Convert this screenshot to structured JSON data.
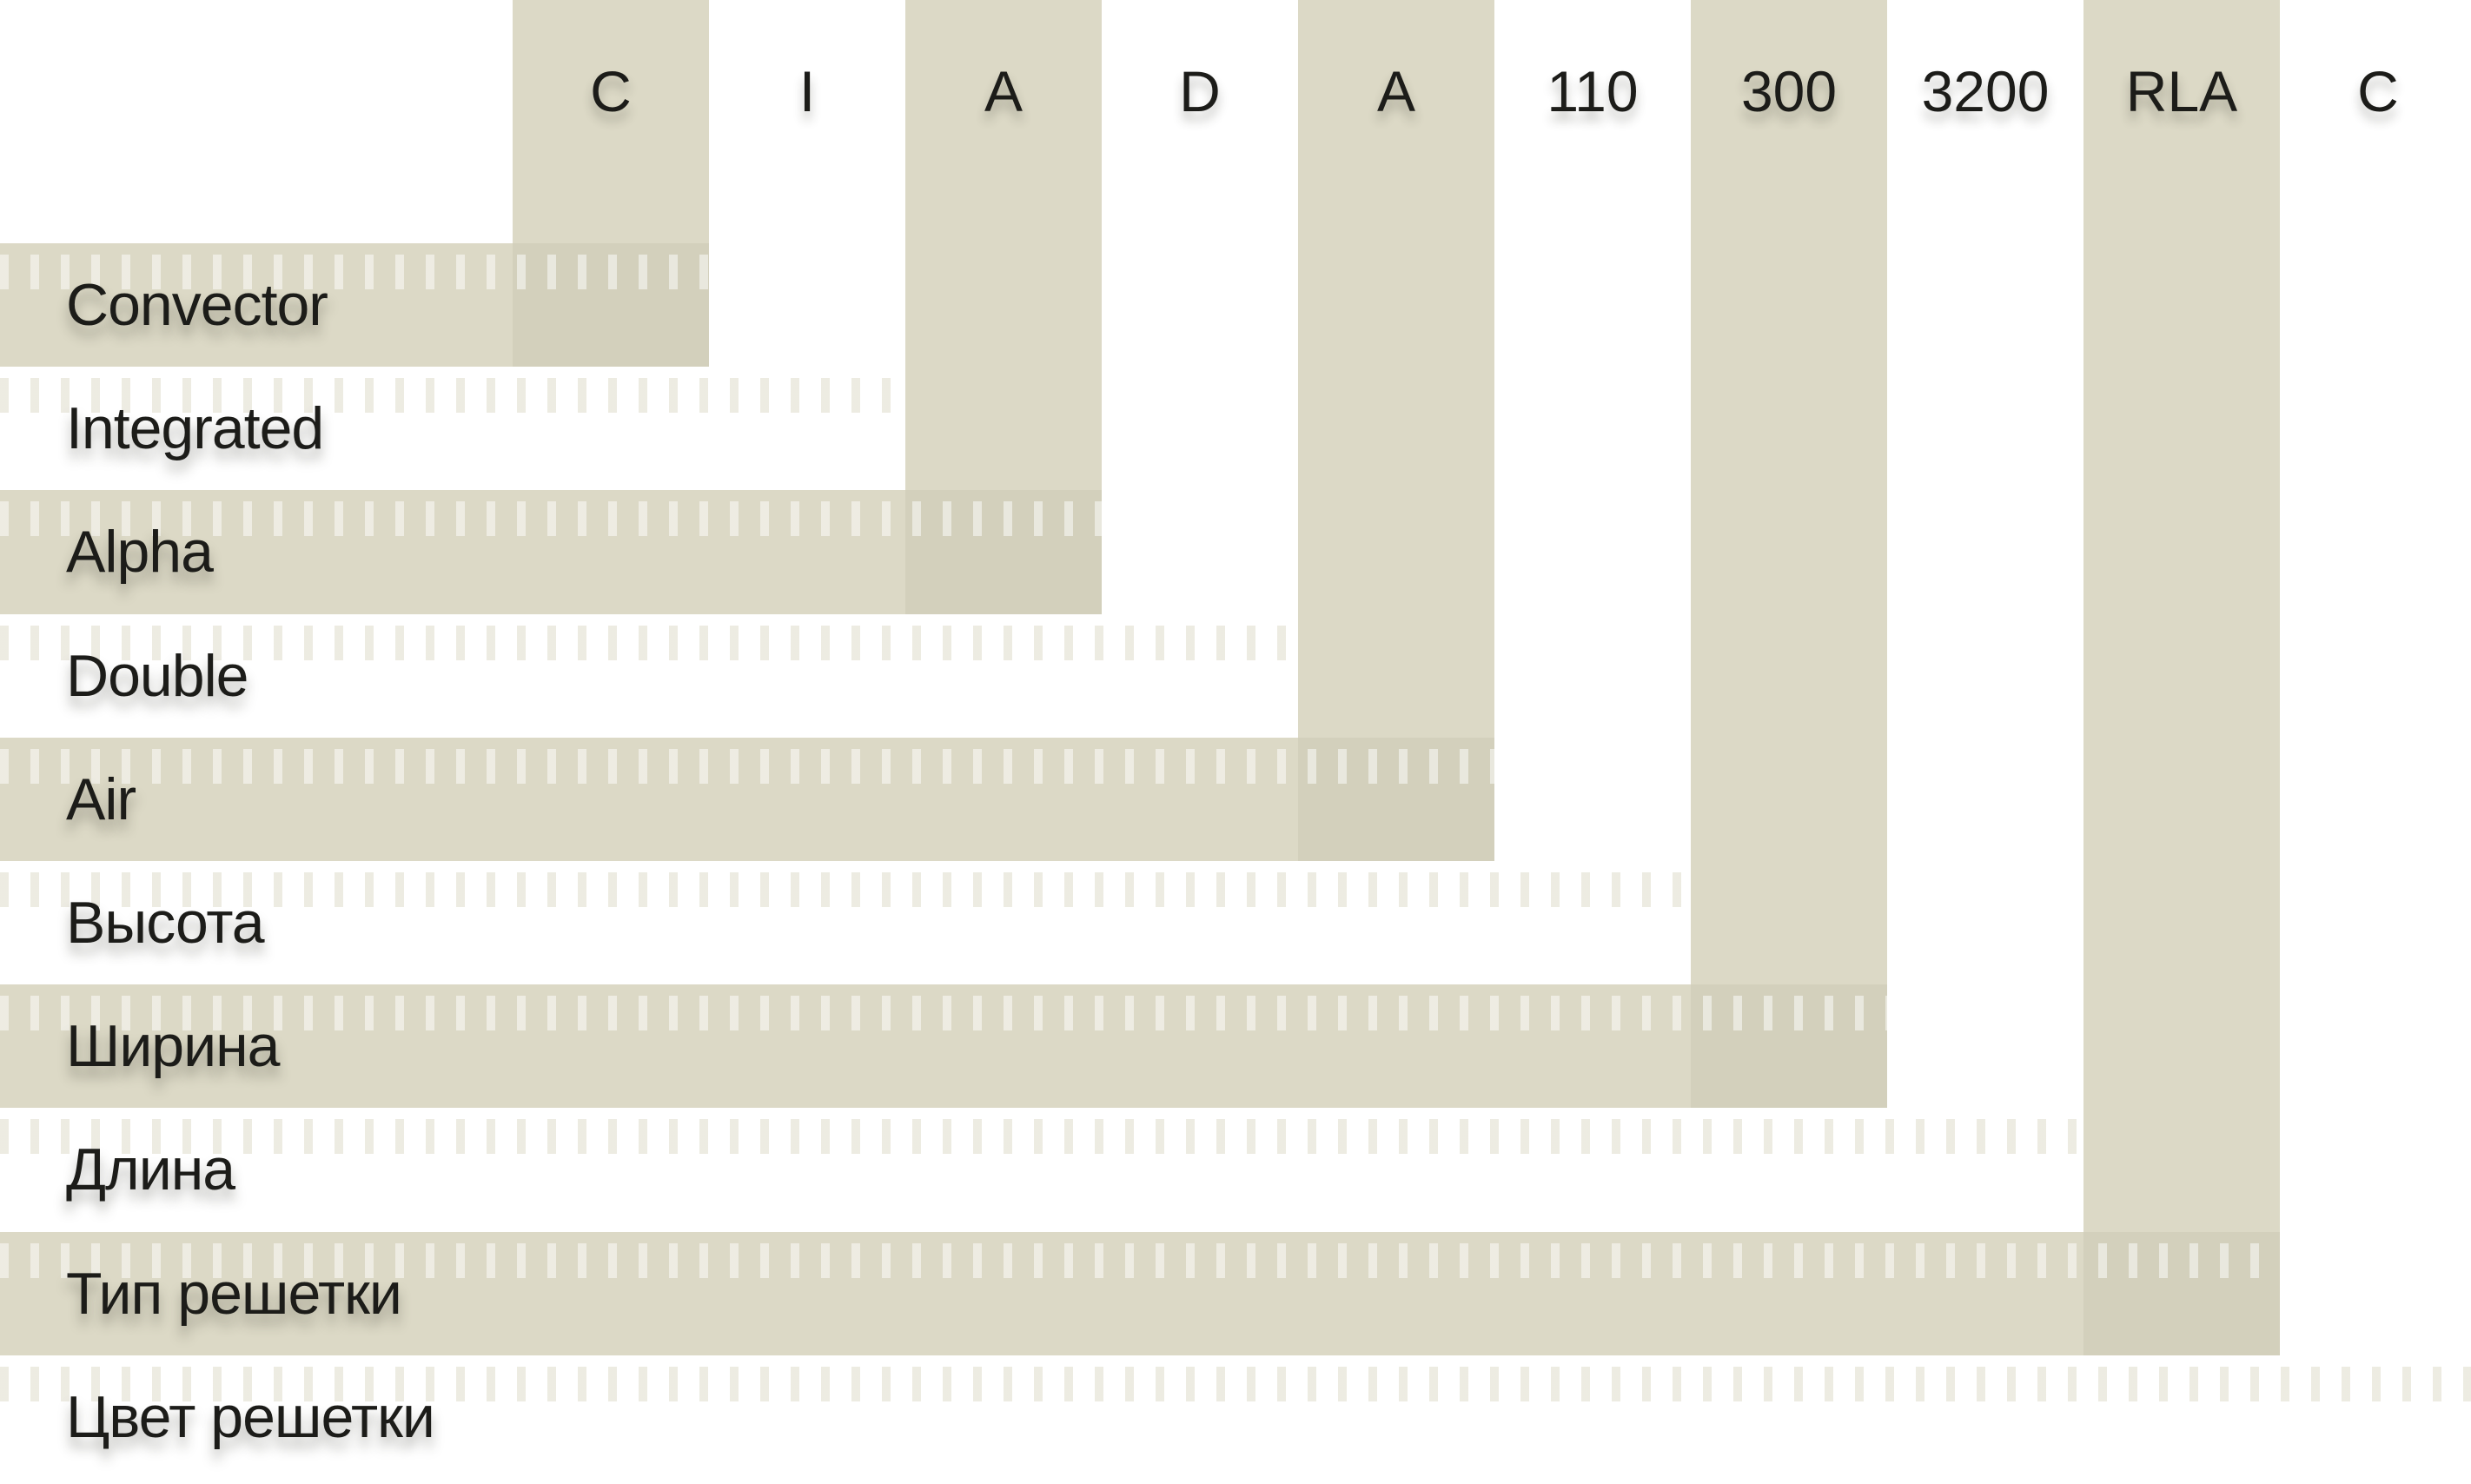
{
  "theme": {
    "background": "#ffffff",
    "band_color": "#dcd9c6",
    "band_overlap_color": "#d3d0bc",
    "text_color": "#1c1c19"
  },
  "columns": [
    {
      "code": "C",
      "label": "Convector"
    },
    {
      "code": "I",
      "label": "Integrated"
    },
    {
      "code": "A",
      "label": "Alpha"
    },
    {
      "code": "D",
      "label": "Double"
    },
    {
      "code": "A",
      "label": "Air"
    },
    {
      "code": "110",
      "label": "Высота"
    },
    {
      "code": "300",
      "label": "Ширина"
    },
    {
      "code": "3200",
      "label": "Длина"
    },
    {
      "code": "RLA",
      "label": "Тип решетки"
    },
    {
      "code": "C",
      "label": "Цвет решетки"
    }
  ]
}
